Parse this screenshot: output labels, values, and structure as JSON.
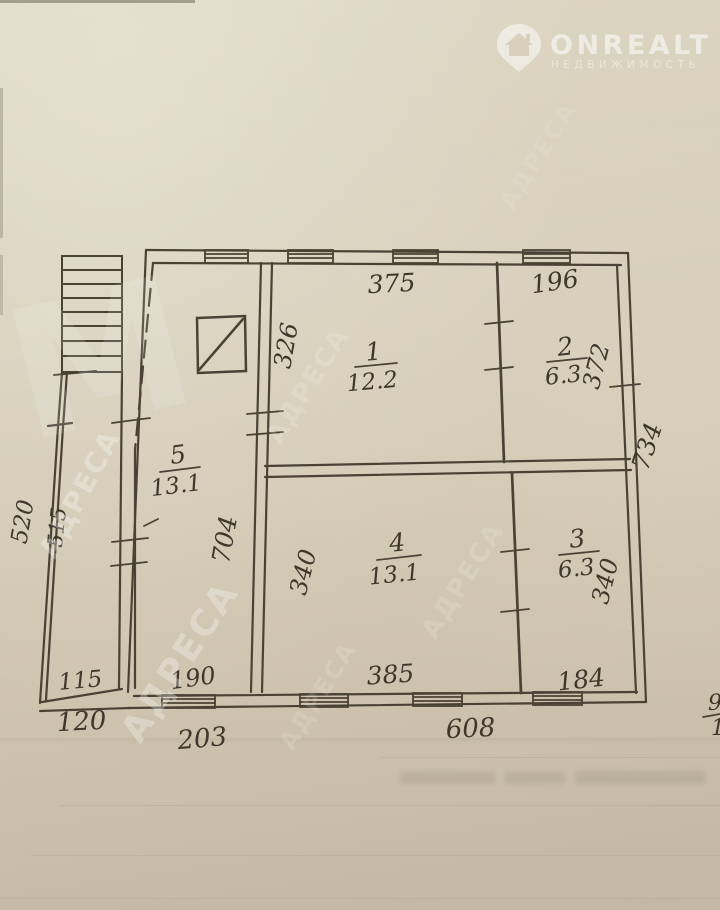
{
  "brand": {
    "name": "ONREALT",
    "subtitle": "НЕДВИЖИМОСТЬ"
  },
  "watermark": {
    "text": "АДРЕСА",
    "monogram": "М"
  },
  "plan": {
    "rooms": {
      "r1": {
        "number": "1",
        "area": "12.2"
      },
      "r2": {
        "number": "2",
        "area": "6.3"
      },
      "r3": {
        "number": "3",
        "area": "6.3"
      },
      "r4": {
        "number": "4",
        "area": "13.1"
      },
      "r5": {
        "number": "5",
        "area": "13.1"
      }
    },
    "dimensions": {
      "room1_width_top": "375",
      "room2_width_top": "196",
      "room1_height_left": "326",
      "room2_height_right": "372",
      "right_total_height": "734",
      "hall_height": "704",
      "room4_height_left": "340",
      "room3_height_right": "340",
      "room4_width_bottom": "385",
      "room3_width_bottom": "184",
      "bottom_total_width": "608",
      "hall_width_bottom": "190",
      "hall_width_outer": "203",
      "porch_width": "115",
      "porch_width_outer": "120",
      "left_outer_height_upper": "520",
      "left_outer_height_lower": "515"
    },
    "edge_fragment": {
      "numerator": "9",
      "denominator": "1"
    }
  }
}
